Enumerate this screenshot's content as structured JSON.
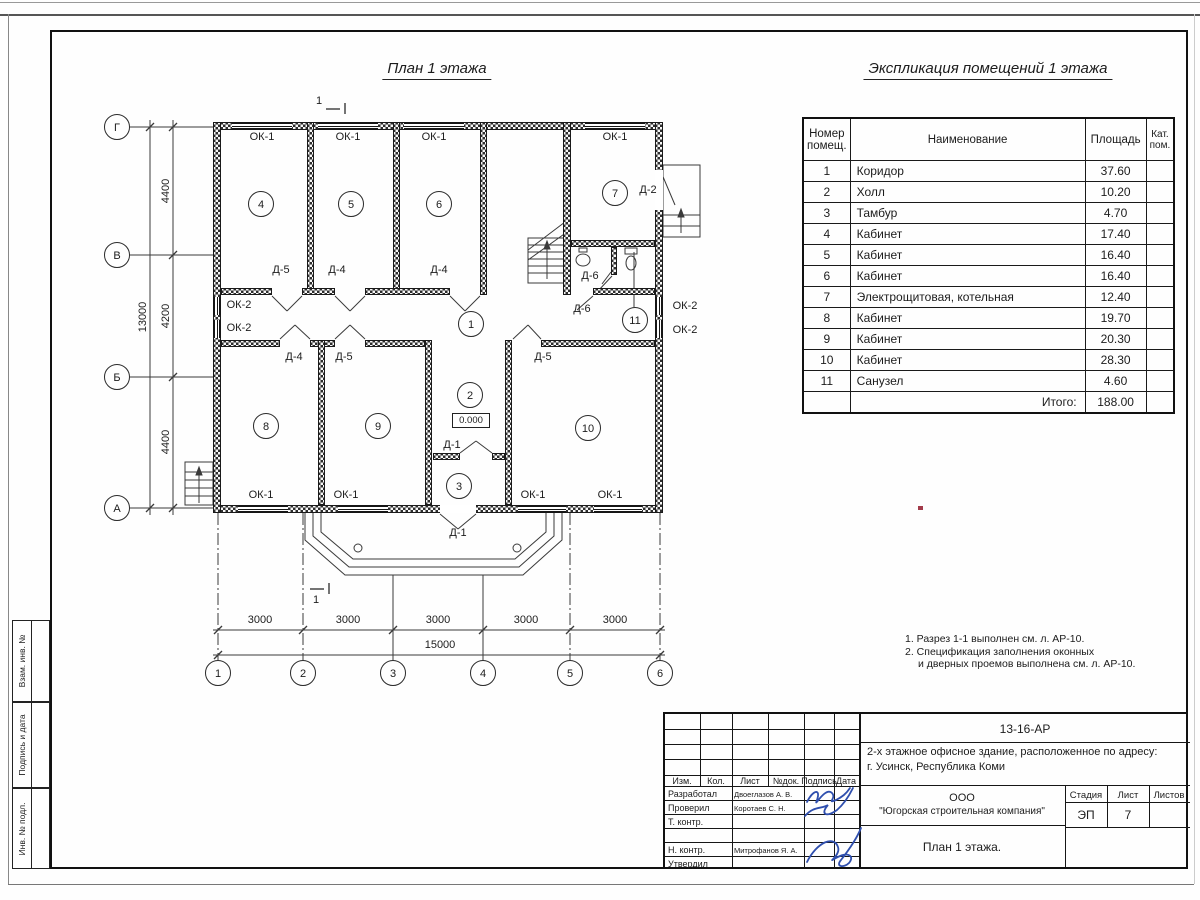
{
  "plan": {
    "title": "План 1 этажа",
    "labels": {
      "ok1": "ОК-1",
      "ok2": "ОК-2",
      "d1": "Д-1",
      "d2": "Д-2",
      "d4": "Д-4",
      "d5": "Д-5",
      "d6": "Д-6"
    },
    "room_numbers": [
      "1",
      "2",
      "3",
      "4",
      "5",
      "6",
      "7",
      "8",
      "9",
      "10",
      "11"
    ],
    "elevation": "0.000",
    "section_mark": "1",
    "axes": {
      "letters": [
        "Г",
        "В",
        "Б",
        "А"
      ],
      "numbers": [
        "1",
        "2",
        "3",
        "4",
        "5",
        "6"
      ]
    },
    "dimensions": {
      "h1": "4400",
      "h2": "4200",
      "h3": "4400",
      "h_total": "13000",
      "w": "3000",
      "w_total": "15000"
    }
  },
  "explication": {
    "title": "Экспликация помещений 1 этажа",
    "headers": {
      "num": "Номер помещ.",
      "name": "Наименование",
      "area": "Площадь",
      "cat": "Кат. пом."
    },
    "rows": [
      {
        "num": "1",
        "name": "Коридор",
        "area": "37.60",
        "cat": ""
      },
      {
        "num": "2",
        "name": "Холл",
        "area": "10.20",
        "cat": ""
      },
      {
        "num": "3",
        "name": "Тамбур",
        "area": "4.70",
        "cat": ""
      },
      {
        "num": "4",
        "name": "Кабинет",
        "area": "17.40",
        "cat": ""
      },
      {
        "num": "5",
        "name": "Кабинет",
        "area": "16.40",
        "cat": ""
      },
      {
        "num": "6",
        "name": "Кабинет",
        "area": "16.40",
        "cat": ""
      },
      {
        "num": "7",
        "name": "Электрощитовая, котельная",
        "area": "12.40",
        "cat": ""
      },
      {
        "num": "8",
        "name": "Кабинет",
        "area": "19.70",
        "cat": ""
      },
      {
        "num": "9",
        "name": "Кабинет",
        "area": "20.30",
        "cat": ""
      },
      {
        "num": "10",
        "name": "Кабинет",
        "area": "28.30",
        "cat": ""
      },
      {
        "num": "11",
        "name": "Санузел",
        "area": "4.60",
        "cat": ""
      }
    ],
    "total_label": "Итого:",
    "total_area": "188.00"
  },
  "notes": {
    "line1": "1. Разрез 1-1 выполнен см. л. АР-10.",
    "line2": "2. Спецификация заполнения оконных",
    "line3": "и дверных проемов выполнена см. л. АР-10."
  },
  "stamp": {
    "doc_number": "13-16-АР",
    "project_line1": "2-х этажное офисное здание, расположенное по адресу:",
    "project_line2": "г. Усинск, Республика Коми",
    "company_line1": "ООО",
    "company_line2": "\"Югорская строительная компания\"",
    "sheet_title": "План 1 этажа.",
    "cols": {
      "izm": "Изм.",
      "kol": "Кол.",
      "list": "Лист",
      "ndok": "№док.",
      "podpis": "Подпись",
      "data": "Дата"
    },
    "roles": {
      "developed": "Разработал",
      "checked": "Проверил",
      "tcontr": "Т. контр.",
      "ncontr": "Н. контр.",
      "approved": "Утвердил"
    },
    "names": {
      "developed": "Двоеглазов А. В.",
      "checked": "Коротаев С. Н.",
      "ncontr": "Митрофанов Я. А."
    },
    "stage": {
      "label": "Стадия",
      "value": "ЭП"
    },
    "sheet": {
      "label": "Лист",
      "value": "7"
    },
    "sheets": {
      "label": "Листов",
      "value": ""
    }
  },
  "side_labels": {
    "vzam": "Взам. инв. №",
    "podpis": "Подпись и дата",
    "inv": "Инв. № подл."
  }
}
